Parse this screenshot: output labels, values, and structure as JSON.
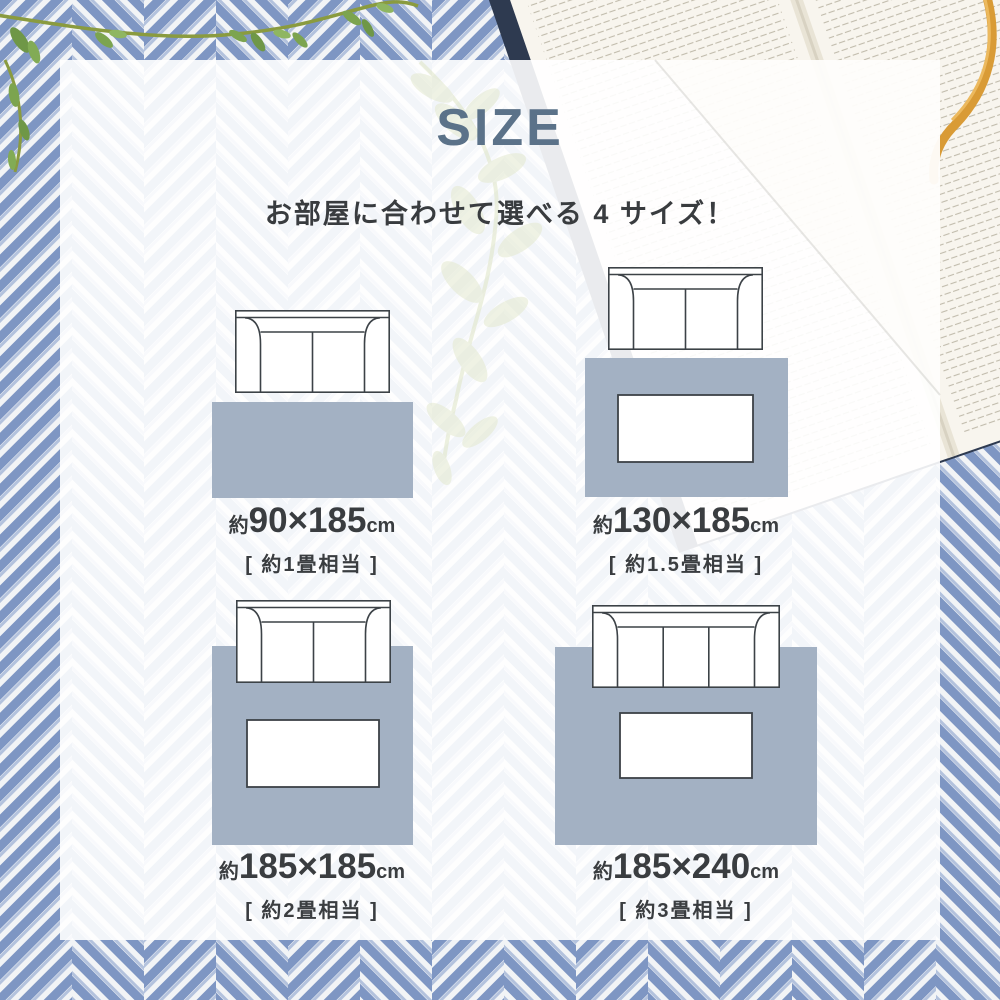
{
  "header": {
    "title": "SIZE",
    "subtitle": "お部屋に合わせて選べる 4 サイズ！"
  },
  "sizes": [
    {
      "approx": "約",
      "dimensions": "90×185",
      "unit": "cm",
      "tatami": "[ 約1畳相当 ]"
    },
    {
      "approx": "約",
      "dimensions": "130×185",
      "unit": "cm",
      "tatami": "[ 約1.5畳相当 ]"
    },
    {
      "approx": "約",
      "dimensions": "185×185",
      "unit": "cm",
      "tatami": "[ 約2畳相当 ]"
    },
    {
      "approx": "約",
      "dimensions": "185×240",
      "unit": "cm",
      "tatami": "[ 約3畳相当 ]"
    }
  ],
  "colors": {
    "title": "#5b7289",
    "text": "#3a3d40",
    "rug": "#a3b1c3",
    "outline": "#3c4247",
    "fabric_blue": "#7e96c3",
    "fabric_white": "#f2f4f6",
    "book_cover": "#2e3a50",
    "book_pages": "#f8f5ee",
    "ribbon": "#d99b36",
    "leaf": "#7ca44f"
  },
  "icons": {
    "sofa-icon": "sofa top view outline",
    "rug-icon": "rug area swatch",
    "table-icon": "low table outline",
    "plant-vine-icon": "green vine with leaves",
    "open-book": "open book pages",
    "bookmark-ribbon-icon": "orange ribbon bookmark"
  }
}
